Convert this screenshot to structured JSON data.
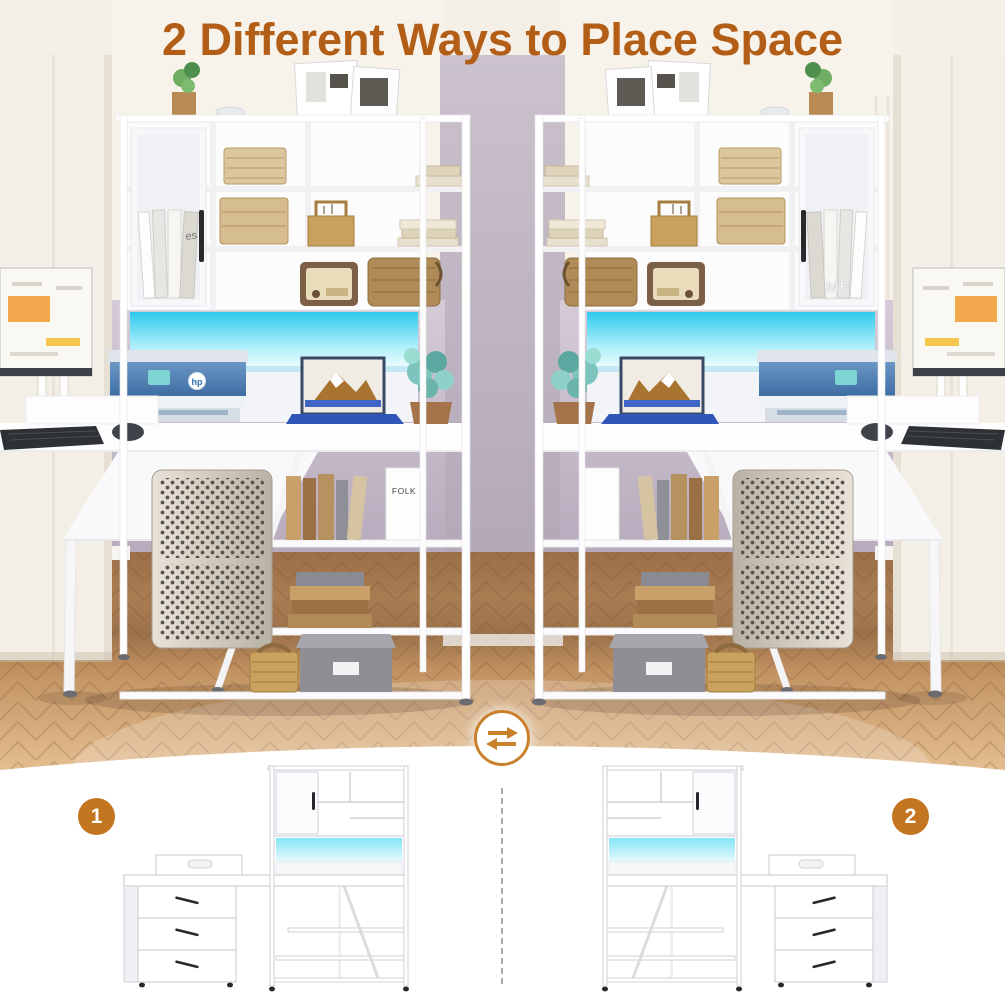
{
  "title": {
    "text": "2 Different Ways to Place Space",
    "color": "#b35e17"
  },
  "swap": {
    "icon": "swap-arrows-icon",
    "ring_color": "#c9812e",
    "arrow_color": "#c9812e"
  },
  "divider": {
    "type": "vertical-dashed",
    "color": "#ababab"
  },
  "badge_color": "#c3761f",
  "options": [
    {
      "badge": "1",
      "layout": "drawers-left-hutch-right"
    },
    {
      "badge": "2",
      "layout": "hutch-left-drawers-right"
    }
  ],
  "scene": {
    "led_color": "#2fcaed",
    "wall_color": "#bfb3c4",
    "floor_color": "#b5895c",
    "furniture_color": "#ffffff",
    "decor_text": {
      "magazine_masthead": "es",
      "magazine_cover": "FOLK",
      "printer_logo": "hp",
      "shelf_letters": "ME"
    }
  }
}
